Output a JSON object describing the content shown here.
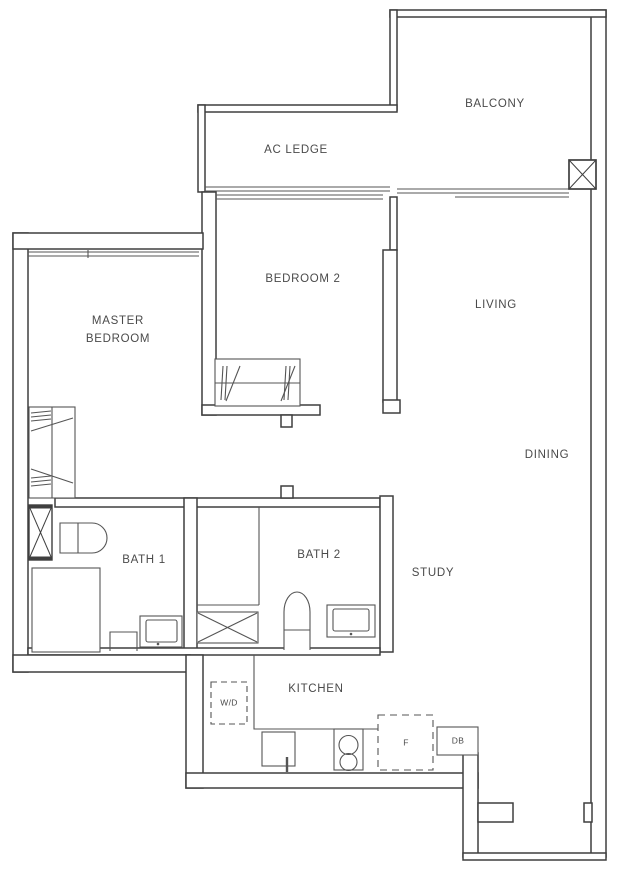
{
  "colors": {
    "wall_line": "#3f3f3f",
    "fixture_line": "#555555",
    "label_text": "#4a4a4a",
    "background": "#ffffff"
  },
  "rooms": {
    "balcony": {
      "label": "BALCONY"
    },
    "ac_ledge": {
      "label": "AC LEDGE"
    },
    "bedroom2": {
      "label": "BEDROOM 2"
    },
    "living": {
      "label": "LIVING"
    },
    "master_bedroom": {
      "label": "MASTER\nBEDROOM"
    },
    "dining": {
      "label": "DINING"
    },
    "bath1": {
      "label": "BATH 1"
    },
    "bath2": {
      "label": "BATH 2"
    },
    "study": {
      "label": "STUDY"
    },
    "kitchen": {
      "label": "KITCHEN"
    }
  },
  "appliances": {
    "washer_dryer": {
      "label": "W/D"
    },
    "fridge": {
      "label": "F"
    },
    "distribution_board": {
      "label": "DB"
    }
  }
}
